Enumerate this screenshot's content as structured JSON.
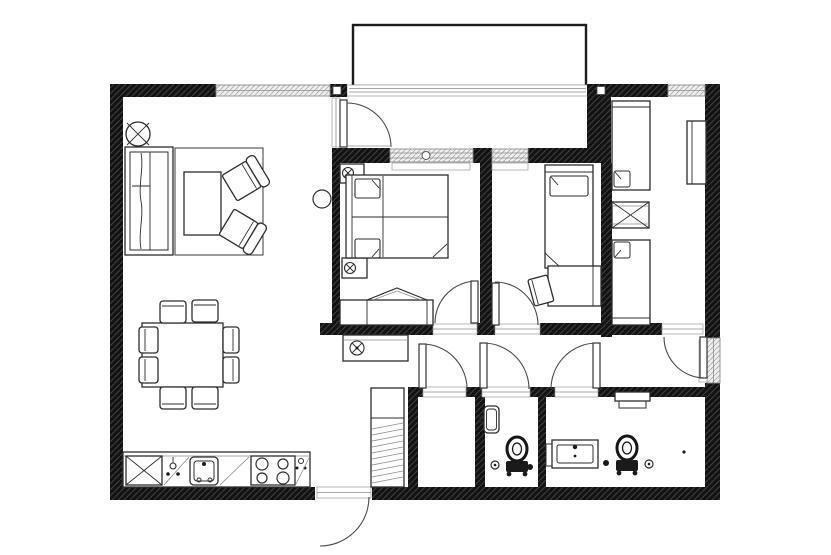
{
  "document": {
    "title": "Apartment Floor Plan",
    "type": "architectural-floor-plan",
    "background": "#ffffff"
  },
  "palette": {
    "paper": "#ffffff",
    "walls": "#131313",
    "wall_hatch": "#3f3f3f",
    "furniture_line": "#2d2d2d",
    "thin_line": "#8c8c8c",
    "window_fill": "#efefef",
    "window_line": "#aeaeae",
    "door_arc": "#4a4a4a"
  },
  "plan": {
    "rooms": [
      {
        "id": "living-room",
        "label": "Living Room",
        "furniture": [
          "sofa",
          "area-rug",
          "coffee-table",
          "armchair",
          "armchair",
          "ceiling-light"
        ]
      },
      {
        "id": "dining-area",
        "label": "Dining Area",
        "furniture": [
          "dining-table",
          "dining-chair x8"
        ]
      },
      {
        "id": "kitchen",
        "label": "Kitchen",
        "furniture": [
          "counter",
          "sink",
          "cooktop-4-burners",
          "crossed-cabinet",
          "faucet"
        ]
      },
      {
        "id": "master-bedroom",
        "label": "Master Bedroom",
        "furniture": [
          "double-bed",
          "nightstand-lamp",
          "nightstand-lamp",
          "dresser-bench"
        ]
      },
      {
        "id": "bedroom-2",
        "label": "Bedroom 2",
        "furniture": [
          "single-bed",
          "desk",
          "desk-chair"
        ]
      },
      {
        "id": "bedroom-3",
        "label": "Bedroom 3",
        "furniture": [
          "single-bed",
          "single-bed",
          "crossed-side-table",
          "wardrobe"
        ]
      },
      {
        "id": "hallway",
        "label": "Hallway",
        "furniture": []
      },
      {
        "id": "storage-closet",
        "label": "Storage Closet",
        "furniture": [
          "shelving-unit"
        ]
      },
      {
        "id": "wc",
        "label": "WC",
        "furniture": [
          "toilet",
          "hand-basin",
          "paper-holder"
        ]
      },
      {
        "id": "bathroom",
        "label": "Bathroom",
        "furniture": [
          "toilet",
          "vanity-sink",
          "wall-shelf",
          "paper-holder"
        ]
      },
      {
        "id": "balcony",
        "label": "Balcony",
        "furniture": []
      },
      {
        "id": "loggia",
        "label": "Loggia",
        "furniture": [
          "sideboard",
          "extractor-symbol",
          "wall-light"
        ]
      }
    ],
    "door_count": 8,
    "window_count": 5
  }
}
